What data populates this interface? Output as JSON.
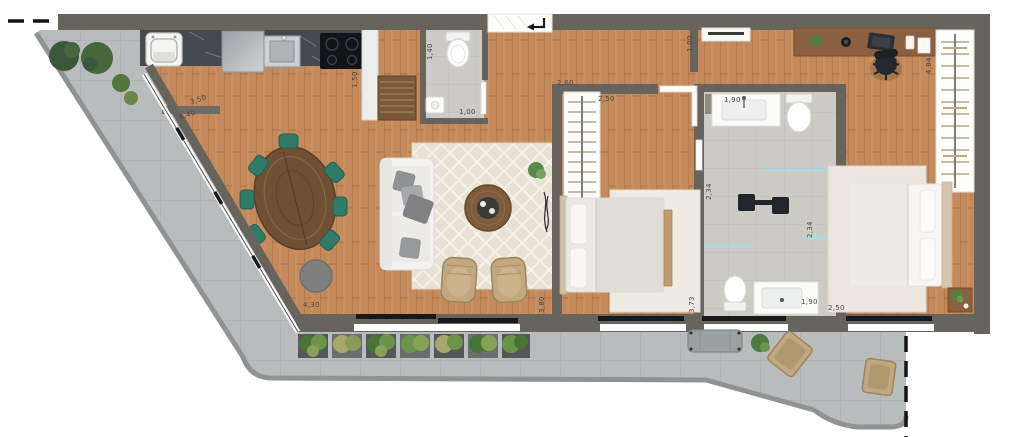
{
  "plan_type": "apartment-floor-plan",
  "labels": [
    {
      "id": "kitchen-width",
      "text": "3,50"
    },
    {
      "id": "terrace-length",
      "text": "6,40"
    },
    {
      "id": "kitchen-cabinet-depth",
      "text": "1,50"
    },
    {
      "id": "powder-room-width",
      "text": "1,40"
    },
    {
      "id": "powder-room-depth",
      "text": "1,00"
    },
    {
      "id": "bedroom1-wardrobe-width",
      "text": "2,60"
    },
    {
      "id": "hall-width",
      "text": "2,50"
    },
    {
      "id": "suite-entry-width",
      "text": "1,00"
    },
    {
      "id": "bathroom1-vanity-width",
      "text": "1,90"
    },
    {
      "id": "shower1-depth",
      "text": "2,34"
    },
    {
      "id": "shower2-depth",
      "text": "2,34"
    },
    {
      "id": "suite-wardrobe-length",
      "text": "4,84"
    },
    {
      "id": "bathroom2-vanity-width",
      "text": "1,90"
    },
    {
      "id": "suite-width",
      "text": "2,50"
    },
    {
      "id": "balcony-length",
      "text": "4,30"
    },
    {
      "id": "living-depth",
      "text": "3,80"
    },
    {
      "id": "bedroom1-depth",
      "text": "3,73"
    }
  ],
  "colors": {
    "wall": "#67645e",
    "wood_floor": "#c58a5b",
    "terrace_tile": "#b8bcbd",
    "bathroom_tile": "#cdcbc6",
    "rug": "#e8e2d5",
    "chair_teal": "#2e7b67",
    "table_wood": "#6f5034",
    "wicker": "#c2a87f",
    "plant_green": "#4f7040",
    "granite": "#45484d",
    "label_text": "#4c4741"
  }
}
